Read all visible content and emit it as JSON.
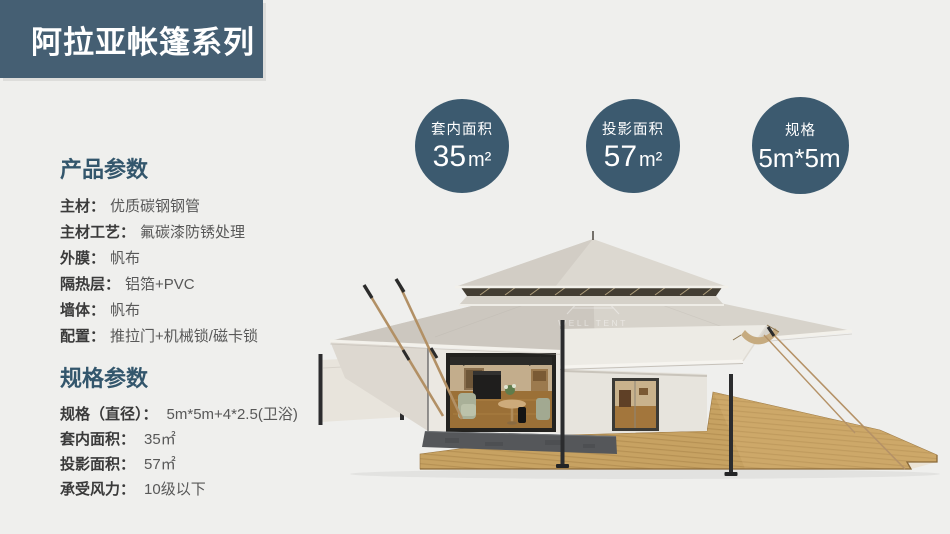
{
  "colors": {
    "background": "#efefed",
    "banner_bg": "#455f73",
    "badge_bg": "#3c5a6f",
    "heading": "#33566c",
    "deck_wood": "#c7a262",
    "canvas": "#e9e6e0"
  },
  "banner": {
    "title": "阿拉亚帐篷系列"
  },
  "badges": [
    {
      "label": "套内面积",
      "value": "35",
      "unit": "m²"
    },
    {
      "label": "投影面积",
      "value": "57",
      "unit": "m²"
    },
    {
      "label": "规格",
      "value": "5m*5m",
      "unit": ""
    }
  ],
  "product_params": {
    "heading": "产品参数",
    "items": [
      {
        "label": "主材：",
        "value": "优质碳钢钢管"
      },
      {
        "label": "主材工艺：",
        "value": "氟碳漆防锈处理"
      },
      {
        "label": "外膜：",
        "value": "帆布"
      },
      {
        "label": "隔热层：",
        "value": "铝箔+PVC"
      },
      {
        "label": "墙体：",
        "value": "帆布"
      },
      {
        "label": "配置：",
        "value": "推拉门+机械锁/磁卡锁"
      }
    ]
  },
  "spec_params": {
    "heading": "规格参数",
    "items": [
      {
        "label": "规格（直径）：",
        "value": "5m*5m+4*2.5(卫浴)"
      },
      {
        "label": "套内面积：",
        "value": "35㎡"
      },
      {
        "label": "投影面积：",
        "value": "57㎡"
      },
      {
        "label": "承受风力：",
        "value": "10级以下"
      }
    ]
  },
  "tent": {
    "watermark": "WELL TENT"
  }
}
